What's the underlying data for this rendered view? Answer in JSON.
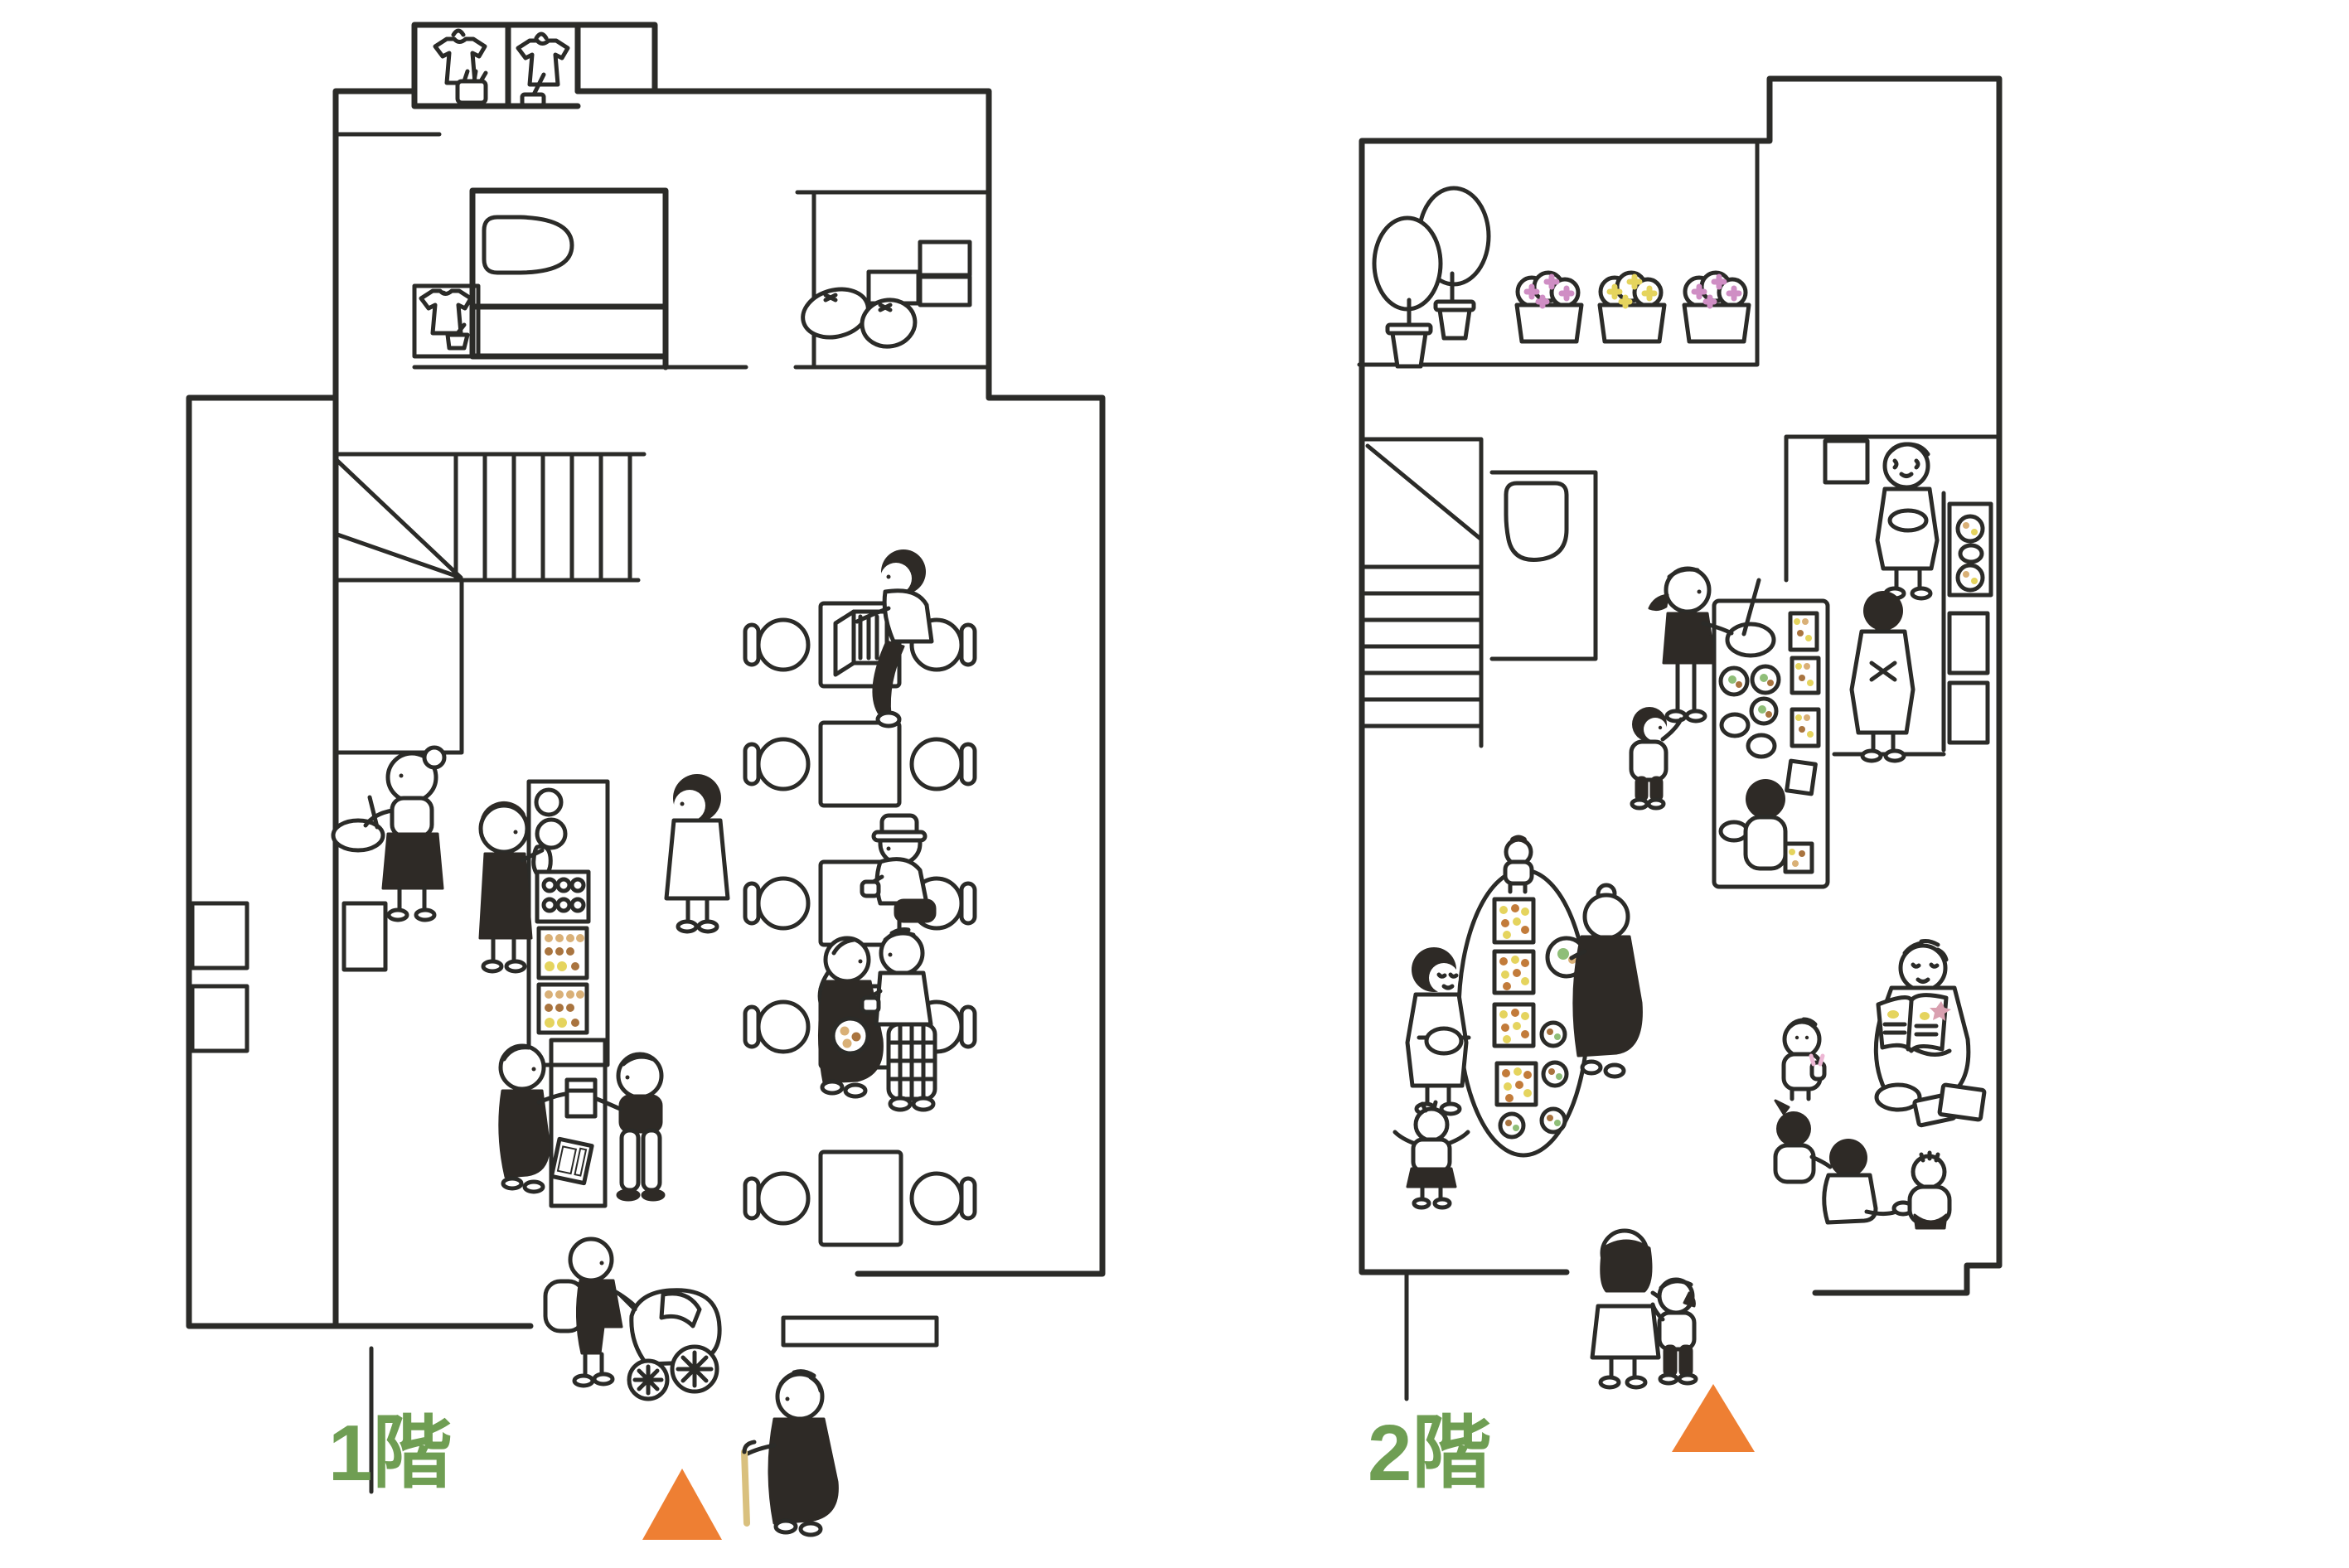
{
  "title": "Two-story building illustrated floor plan",
  "floors": [
    {
      "id": "floor-1",
      "label": "1階",
      "entrance_marker": "orange-triangle",
      "rooms": [
        "closet-with-shirts",
        "laundry-corner",
        "bathroom",
        "storage-room",
        "winder-staircase",
        "kitchen",
        "food-display-counter",
        "cash-register-counter",
        "cafe-seating-five-tables",
        "street-entrance"
      ],
      "objects": [
        "yellow-shirt",
        "purple-shirt",
        "green-shirt",
        "basket",
        "broom",
        "dustpan",
        "bathtub",
        "cardboard-boxes",
        "flour-sacks",
        "mixing-bowl",
        "egg-tray",
        "food-trays",
        "paper-bag",
        "cash-register",
        "wooden-crate",
        "teacups",
        "cookie-plate",
        "baby-stroller",
        "walking-cane"
      ],
      "people": [
        "woman-stirring-bowl",
        "staff-arranging-food",
        "woman-standing",
        "man-with-crate-at-table",
        "man-with-hat-drinking-tea",
        "elderly-woman-with-braid",
        "man-in-plaid-pants",
        "staff-handing-bag",
        "customer-receiving-bag",
        "person-pushing-stroller",
        "elderly-woman-with-cane"
      ]
    },
    {
      "id": "floor-2",
      "label": "2階",
      "entrance_marker": "orange-triangle",
      "rooms": [
        "balcony-with-plants",
        "staircase",
        "toilet-room",
        "kitchen",
        "island-counter",
        "oval-dining-table",
        "reading-corner",
        "stair-landing"
      ],
      "objects": [
        "potted-trees",
        "flower-planters",
        "toilet",
        "stove-with-pans",
        "cupboards",
        "blue-mixing-bowl",
        "pink-egg-bowls",
        "food-trays",
        "serving-plates",
        "pink-plate",
        "blue-pot",
        "green-picture-book",
        "floor-books",
        "pink-bunny-toy"
      ],
      "people": [
        "grandmother-carrying-plate",
        "woman-in-apron",
        "mother-stirring-bowl",
        "toddler-reaching",
        "boy-with-bowl",
        "baby-on-table",
        "grandmother-serving-plate",
        "woman-with-pot",
        "toddler-arms-up",
        "elderly-man-reading-picture-book",
        "toddler-with-bunny",
        "girl-with-ponytail",
        "boy-sitting",
        "baby-sitting",
        "mother-and-child-walking"
      ]
    }
  ],
  "colors": {
    "line": "#2b2b28",
    "floor_label_green": "#6f9e53",
    "entrance_orange": "#ee7f33",
    "table_cream": "#eae3c8",
    "counter_cream": "#efe9d8",
    "oval_table_peach": "#f5e8d4",
    "bath_mint": "#d9eae2",
    "toilet_blue": "#d8e9e7",
    "stroller_pink": "#f0cfc3",
    "teal_bowl": "#c2ddd6",
    "blue_bowl": "#cfe3ea",
    "box_tan": "#d2c89c",
    "sack_cream": "#f4ecd9",
    "shirt_yellow": "#e3da82",
    "shirt_purple": "#d4b0d8",
    "shirt_green": "#a5c6a4",
    "tree_green": "#8fbe78",
    "tree_green_light": "#b3c786",
    "planter_cream": "#efe9b6",
    "flower_pink": "#cf8ec4",
    "flower_yellow": "#e5d45e",
    "picture_book_green": "#a8d3b0",
    "book_green": "#b7cb7a",
    "book_orange": "#e9b568",
    "plate_pink": "#f2b9c6",
    "register_gray": "#b9bcc0",
    "cane_tan": "#d9c07e",
    "wheel_gray": "#c7c7c7",
    "pan_dark": "#4a443e",
    "bag_tan": "#ead9b0",
    "pot_brown": "#a58f5e",
    "food_tan": "#d9b077",
    "food_brown": "#a9743f"
  }
}
